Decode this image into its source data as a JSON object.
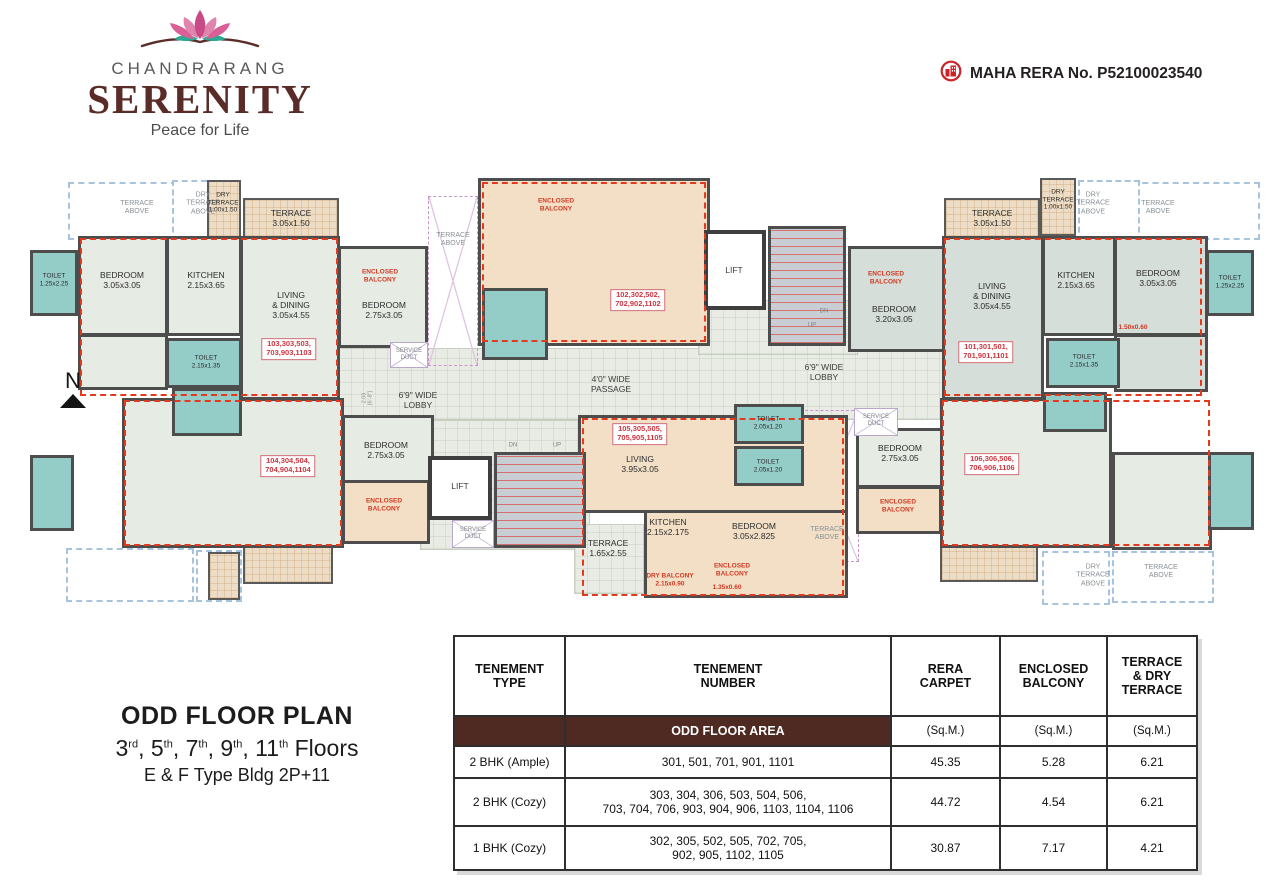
{
  "header": {
    "brand": "CHANDRARANG",
    "title": "SERENITY",
    "tagline": "Peace for Life",
    "rera_label": "MAHA RERA No. P52100023540"
  },
  "plan_info": {
    "title": "ODD FLOOR PLAN",
    "floors": [
      [
        "3",
        "rd"
      ],
      [
        "5",
        "th"
      ],
      [
        "7",
        "th"
      ],
      [
        "9",
        "th"
      ],
      [
        "11",
        "th"
      ]
    ],
    "floors_suffix": "Floors",
    "building": "E & F Type Bldg 2P+11",
    "north": "N"
  },
  "colors": {
    "brand_maroon": "#5a2c28",
    "band_brown": "#4e2a22",
    "unit_red": "#e4391c",
    "toilet_teal": "#94ccc8",
    "unit_tan": "#f2dfc6",
    "room_green": "#e6ebe3",
    "rera_red": "#cc2229"
  },
  "floorplan": {
    "shapes": [
      {
        "n": "lobby-main",
        "c": "lobby",
        "x": 338,
        "y": 348,
        "w": 622,
        "h": 72
      },
      {
        "n": "lobby-core-top",
        "c": "lobby",
        "x": 698,
        "y": 300,
        "w": 160,
        "h": 55
      },
      {
        "n": "lobby-core-bottom",
        "c": "lobby",
        "x": 420,
        "y": 420,
        "w": 170,
        "h": 130
      },
      {
        "n": "terrace-above-left-1",
        "c": "dashb",
        "x": 68,
        "y": 182,
        "w": 140,
        "h": 58
      },
      {
        "n": "dry-terrace-above-left",
        "c": "dashb",
        "x": 172,
        "y": 180,
        "w": 64,
        "h": 62
      },
      {
        "n": "terrace-above-right-1",
        "c": "dashb",
        "x": 1122,
        "y": 182,
        "w": 138,
        "h": 58
      },
      {
        "n": "dry-terrace-above-right",
        "c": "dashb",
        "x": 1078,
        "y": 180,
        "w": 62,
        "h": 62
      },
      {
        "n": "terrace-below-left-1",
        "c": "dashb",
        "x": 66,
        "y": 548,
        "w": 128,
        "h": 54
      },
      {
        "n": "terrace-below-left-2",
        "c": "dashb",
        "x": 196,
        "y": 550,
        "w": 46,
        "h": 52
      },
      {
        "n": "terrace-above-bottom-right",
        "c": "dashb",
        "x": 1112,
        "y": 551,
        "w": 102,
        "h": 52
      },
      {
        "n": "dry-terrace-above-bottom-right",
        "c": "dashb",
        "x": 1042,
        "y": 551,
        "w": 68,
        "h": 54
      },
      {
        "n": "terrace-above-center-left",
        "c": "dashp",
        "x": 428,
        "y": 196,
        "w": 50,
        "h": 170
      },
      {
        "n": "terrace-above-center-bottom",
        "c": "dashp",
        "x": 795,
        "y": 410,
        "w": 64,
        "h": 152
      },
      {
        "n": "dry-terrace-left",
        "c": "terr",
        "x": 207,
        "y": 180,
        "w": 34,
        "h": 58
      },
      {
        "n": "terrace-103",
        "c": "terr",
        "x": 243,
        "y": 198,
        "w": 96,
        "h": 40
      },
      {
        "n": "terrace-101",
        "c": "terr",
        "x": 944,
        "y": 198,
        "w": 96,
        "h": 40
      },
      {
        "n": "dry-terrace-right",
        "c": "terr",
        "x": 1040,
        "y": 178,
        "w": 36,
        "h": 58
      },
      {
        "n": "terrace-104",
        "c": "terr",
        "x": 243,
        "y": 536,
        "w": 90,
        "h": 48
      },
      {
        "n": "terrace-104-strip",
        "c": "terr",
        "x": 208,
        "y": 552,
        "w": 32,
        "h": 48
      },
      {
        "n": "terrace-106",
        "c": "terr",
        "x": 940,
        "y": 534,
        "w": 98,
        "h": 48
      },
      {
        "n": "bedroom-103",
        "c": "room",
        "x": 78,
        "y": 236,
        "w": 90,
        "h": 100
      },
      {
        "n": "kitchen-103",
        "c": "room",
        "x": 166,
        "y": 236,
        "w": 76,
        "h": 100
      },
      {
        "n": "living-dining-103",
        "c": "room",
        "x": 240,
        "y": 236,
        "w": 100,
        "h": 164
      },
      {
        "n": "passage-103",
        "c": "room",
        "x": 78,
        "y": 334,
        "w": 90,
        "h": 56
      },
      {
        "n": "bedroom2-103",
        "c": "room",
        "x": 338,
        "y": 246,
        "w": 90,
        "h": 102
      },
      {
        "n": "bedroom2-101",
        "c": "groom",
        "x": 848,
        "y": 246,
        "w": 102,
        "h": 106
      },
      {
        "n": "living-dining-101",
        "c": "groom",
        "x": 942,
        "y": 236,
        "w": 102,
        "h": 164
      },
      {
        "n": "kitchen-101",
        "c": "groom",
        "x": 1042,
        "y": 236,
        "w": 74,
        "h": 100
      },
      {
        "n": "bedroom-101",
        "c": "groom",
        "x": 1114,
        "y": 236,
        "w": 94,
        "h": 100
      },
      {
        "n": "passage-101",
        "c": "groom",
        "x": 1114,
        "y": 334,
        "w": 94,
        "h": 58
      },
      {
        "n": "unit-104-main",
        "c": "room",
        "x": 122,
        "y": 398,
        "w": 222,
        "h": 150
      },
      {
        "n": "bedroom2-104",
        "c": "room",
        "x": 342,
        "y": 415,
        "w": 92,
        "h": 68
      },
      {
        "n": "bedroom2-106",
        "c": "room",
        "x": 856,
        "y": 428,
        "w": 88,
        "h": 60
      },
      {
        "n": "unit-106-main",
        "c": "room",
        "x": 940,
        "y": 398,
        "w": 172,
        "h": 150
      },
      {
        "n": "bedroom-106",
        "c": "room",
        "x": 1112,
        "y": 452,
        "w": 100,
        "h": 98
      },
      {
        "n": "terrace-105",
        "c": "lobby",
        "x": 574,
        "y": 524,
        "w": 70,
        "h": 70
      },
      {
        "n": "unit-102",
        "c": "tan",
        "x": 478,
        "y": 178,
        "w": 232,
        "h": 168
      },
      {
        "n": "unit-105-upper",
        "c": "tan",
        "x": 578,
        "y": 415,
        "w": 270,
        "h": 98
      },
      {
        "n": "unit-105-lower",
        "c": "tan",
        "x": 644,
        "y": 510,
        "w": 204,
        "h": 88
      },
      {
        "n": "enclosed-balcony-104",
        "c": "tan",
        "x": 342,
        "y": 480,
        "w": 88,
        "h": 64
      },
      {
        "n": "enclosed-balcony-106",
        "c": "tan",
        "x": 856,
        "y": 486,
        "w": 86,
        "h": 48
      },
      {
        "n": "toilet-103-a",
        "c": "toilet",
        "x": 30,
        "y": 250,
        "w": 48,
        "h": 66
      },
      {
        "n": "toilet-103-b",
        "c": "toilet",
        "x": 166,
        "y": 338,
        "w": 76,
        "h": 50
      },
      {
        "n": "toilet-102",
        "c": "toilet",
        "x": 482,
        "y": 288,
        "w": 66,
        "h": 72
      },
      {
        "n": "toilet-101-a",
        "c": "toilet",
        "x": 1206,
        "y": 250,
        "w": 48,
        "h": 66
      },
      {
        "n": "toilet-101-b",
        "c": "toilet",
        "x": 1046,
        "y": 338,
        "w": 74,
        "h": 50
      },
      {
        "n": "toilet-104-a",
        "c": "toilet",
        "x": 172,
        "y": 388,
        "w": 70,
        "h": 48
      },
      {
        "n": "toilet-104-b",
        "c": "toilet",
        "x": 30,
        "y": 455,
        "w": 44,
        "h": 76
      },
      {
        "n": "toilet-105-a",
        "c": "toilet",
        "x": 734,
        "y": 404,
        "w": 70,
        "h": 40
      },
      {
        "n": "toilet-105-b",
        "c": "toilet",
        "x": 734,
        "y": 446,
        "w": 70,
        "h": 40
      },
      {
        "n": "toilet-106-a",
        "c": "toilet",
        "x": 1043,
        "y": 392,
        "w": 64,
        "h": 40
      },
      {
        "n": "toilet-106-b",
        "c": "toilet",
        "x": 1208,
        "y": 452,
        "w": 46,
        "h": 78
      },
      {
        "n": "lift-1",
        "c": "lift",
        "x": 704,
        "y": 230,
        "w": 62,
        "h": 80
      },
      {
        "n": "staircase-1",
        "c": "stair",
        "x": 768,
        "y": 226,
        "w": 78,
        "h": 120
      },
      {
        "n": "lift-2",
        "c": "lift",
        "x": 428,
        "y": 456,
        "w": 64,
        "h": 64
      },
      {
        "n": "staircase-2",
        "c": "stair",
        "x": 494,
        "y": 452,
        "w": 92,
        "h": 96
      },
      {
        "n": "service-duct-1",
        "c": "duct",
        "x": 390,
        "y": 342,
        "w": 38,
        "h": 26
      },
      {
        "n": "service-duct-2",
        "c": "duct",
        "x": 452,
        "y": 520,
        "w": 42,
        "h": 28
      },
      {
        "n": "service-duct-3",
        "c": "duct",
        "x": 854,
        "y": 408,
        "w": 44,
        "h": 28
      },
      {
        "n": "unit-boundary-103",
        "c": "dashr",
        "x": 80,
        "y": 238,
        "w": 258,
        "h": 158
      },
      {
        "n": "unit-boundary-102",
        "c": "dashr",
        "x": 482,
        "y": 182,
        "w": 224,
        "h": 160
      },
      {
        "n": "unit-boundary-101",
        "c": "dashr",
        "x": 944,
        "y": 238,
        "w": 258,
        "h": 158
      },
      {
        "n": "unit-boundary-104",
        "c": "dashr",
        "x": 124,
        "y": 400,
        "w": 218,
        "h": 146
      },
      {
        "n": "unit-boundary-105",
        "c": "dashr",
        "x": 582,
        "y": 418,
        "w": 262,
        "h": 178
      },
      {
        "n": "unit-boundary-106",
        "c": "dashr",
        "x": 942,
        "y": 400,
        "w": 268,
        "h": 146
      }
    ],
    "labels": [
      {
        "n": "label-terrace-above-l",
        "t": "TERRACE\nABOVE",
        "x": 137,
        "y": 208,
        "c": "a"
      },
      {
        "n": "label-dry-terrace-above-l",
        "t": "DRY\nTERRACE\nABOVE",
        "x": 203,
        "y": 204,
        "c": "a"
      },
      {
        "n": "label-dry-terrace-l",
        "t": "DRY\nTERRACE\n1.00x1.50",
        "x": 223,
        "y": 203,
        "c": "s"
      },
      {
        "n": "label-terrace-103",
        "t": "TERRACE\n3.05x1.50",
        "x": 291,
        "y": 218,
        "c": "r"
      },
      {
        "n": "label-toilet-103a",
        "t": "TOILET\n1.25x2.25",
        "x": 54,
        "y": 280,
        "c": "s"
      },
      {
        "n": "label-bedroom-103",
        "t": "BEDROOM\n3.05x3.05",
        "x": 122,
        "y": 280,
        "c": "r"
      },
      {
        "n": "label-kitchen-103",
        "t": "KITCHEN\n2.15x3.65",
        "x": 206,
        "y": 280,
        "c": "r"
      },
      {
        "n": "label-living-103",
        "t": "LIVING\n& DINING\n3.05x4.55",
        "x": 291,
        "y": 305,
        "c": "r"
      },
      {
        "n": "unit-103-label",
        "t": "103,303,503,\n703,903,1103",
        "x": 289,
        "y": 349,
        "c": "u"
      },
      {
        "n": "label-toilet-103b",
        "t": "TOILET\n2.15x1.35",
        "x": 206,
        "y": 362,
        "c": "s"
      },
      {
        "n": "label-encbal-103",
        "t": "ENCLOSED\nBALCONY",
        "x": 380,
        "y": 276,
        "c": "red"
      },
      {
        "n": "label-bedroom2-103",
        "t": "BEDROOM\n2.75x3.05",
        "x": 384,
        "y": 310,
        "c": "r"
      },
      {
        "n": "label-terrace-above-cl",
        "t": "TERRACE\nABOVE",
        "x": 453,
        "y": 240,
        "c": "a"
      },
      {
        "n": "label-duct-1",
        "t": "SERVICE\nDUCT",
        "x": 409,
        "y": 355,
        "c": "dim"
      },
      {
        "n": "label-encbal-102",
        "t": "ENCLOSED\nBALCONY",
        "x": 556,
        "y": 205,
        "c": "red"
      },
      {
        "n": "unit-102-label",
        "t": "102,302,502,\n702,902,1102",
        "x": 638,
        "y": 300,
        "c": "u"
      },
      {
        "n": "label-lift-1",
        "t": "LIFT",
        "x": 734,
        "y": 270,
        "c": "lob"
      },
      {
        "n": "label-dn-1",
        "t": "DN",
        "x": 824,
        "y": 312,
        "c": "dim"
      },
      {
        "n": "label-up-1",
        "t": "UP",
        "x": 812,
        "y": 326,
        "c": "dim"
      },
      {
        "n": "label-lobby-left",
        "t": "6'9\" WIDE\nLOBBY",
        "x": 418,
        "y": 400,
        "c": "lob"
      },
      {
        "n": "label-lobby-dim",
        "t": "2.03\n[6'-8\"]",
        "x": 368,
        "y": 398,
        "c": "dimv"
      },
      {
        "n": "label-passage",
        "t": "4'0\" WIDE\nPASSAGE",
        "x": 611,
        "y": 384,
        "c": "lob"
      },
      {
        "n": "label-lobby-right",
        "t": "6'9\" WIDE\nLOBBY",
        "x": 824,
        "y": 372,
        "c": "lob"
      },
      {
        "n": "label-encbal-101",
        "t": "ENCLOSED\nBALCONY",
        "x": 886,
        "y": 278,
        "c": "red"
      },
      {
        "n": "label-bedroom2-101",
        "t": "BEDROOM\n3.20x3.05",
        "x": 894,
        "y": 314,
        "c": "r"
      },
      {
        "n": "label-terrace-101",
        "t": "TERRACE\n3.05x1.50",
        "x": 992,
        "y": 218,
        "c": "r"
      },
      {
        "n": "label-living-101",
        "t": "LIVING\n& DINING\n3.05x4.55",
        "x": 992,
        "y": 296,
        "c": "r"
      },
      {
        "n": "unit-101-label",
        "t": "101,301,501,\n701,901,1101",
        "x": 986,
        "y": 352,
        "c": "u"
      },
      {
        "n": "label-dry-terrace-r",
        "t": "DRY\nTERRACE\n1.00x1.50",
        "x": 1058,
        "y": 200,
        "c": "s"
      },
      {
        "n": "label-dry-terrace-above-r",
        "t": "DRY\nTERRACE\nABOVE",
        "x": 1093,
        "y": 204,
        "c": "a"
      },
      {
        "n": "label-terrace-above-r",
        "t": "TERRACE\nABOVE",
        "x": 1158,
        "y": 208,
        "c": "a"
      },
      {
        "n": "label-kitchen-101",
        "t": "KITCHEN\n2.15x3.65",
        "x": 1076,
        "y": 280,
        "c": "r"
      },
      {
        "n": "label-bedroom-101",
        "t": "BEDROOM\n3.05x3.05",
        "x": 1158,
        "y": 278,
        "c": "r"
      },
      {
        "n": "label-toilet-101a",
        "t": "TOILET\n1.25x2.25",
        "x": 1230,
        "y": 282,
        "c": "s"
      },
      {
        "n": "label-dim-150x060",
        "t": "1.50x0.60",
        "x": 1133,
        "y": 328,
        "c": "red"
      },
      {
        "n": "label-toilet-101b",
        "t": "TOILET\n2.15x1.35",
        "x": 1084,
        "y": 361,
        "c": "s"
      },
      {
        "n": "label-duct-3",
        "t": "SERVICE\nDUCT",
        "x": 876,
        "y": 421,
        "c": "dim"
      },
      {
        "n": "unit-104-label",
        "t": "104,304,504,\n704,904,1104",
        "x": 288,
        "y": 466,
        "c": "u"
      },
      {
        "n": "label-bedroom2-104",
        "t": "BEDROOM\n2.75x3.05",
        "x": 386,
        "y": 450,
        "c": "r"
      },
      {
        "n": "label-encbal-104",
        "t": "ENCLOSED\nBALCONY",
        "x": 384,
        "y": 505,
        "c": "red"
      },
      {
        "n": "label-lift-2",
        "t": "LIFT",
        "x": 460,
        "y": 486,
        "c": "lob"
      },
      {
        "n": "label-duct-2",
        "t": "SERVICE\nDUCT",
        "x": 473,
        "y": 534,
        "c": "dim"
      },
      {
        "n": "label-dn-2",
        "t": "DN",
        "x": 513,
        "y": 446,
        "c": "dim"
      },
      {
        "n": "label-up-2",
        "t": "UP",
        "x": 557,
        "y": 446,
        "c": "dim"
      },
      {
        "n": "unit-105-label",
        "t": "105,305,505,\n705,905,1105",
        "x": 640,
        "y": 434,
        "c": "u"
      },
      {
        "n": "label-living-105",
        "t": "LIVING\n3.95x3.05",
        "x": 640,
        "y": 464,
        "c": "r"
      },
      {
        "n": "label-toilet-105a",
        "t": "TOILET\n2.05x1.20",
        "x": 768,
        "y": 423,
        "c": "s"
      },
      {
        "n": "label-toilet-105b",
        "t": "TOILET\n2.05x1.20",
        "x": 768,
        "y": 466,
        "c": "s"
      },
      {
        "n": "label-kitchen-105",
        "t": "KITCHEN\n2.15x2.175",
        "x": 668,
        "y": 527,
        "c": "r"
      },
      {
        "n": "label-bedroom-105",
        "t": "BEDROOM\n3.05x2.825",
        "x": 754,
        "y": 531,
        "c": "r"
      },
      {
        "n": "label-terrace-105",
        "t": "TERRACE\n1.65x2.55",
        "x": 608,
        "y": 548,
        "c": "r"
      },
      {
        "n": "label-drybal-105",
        "t": "DRY BALCONY\n2.15x0.90",
        "x": 670,
        "y": 580,
        "c": "red"
      },
      {
        "n": "label-encbal-105",
        "t": "ENCLOSED\nBALCONY",
        "x": 732,
        "y": 570,
        "c": "red"
      },
      {
        "n": "label-dim-135x060",
        "t": "1.35x0.60",
        "x": 727,
        "y": 588,
        "c": "red"
      },
      {
        "n": "label-terrace-above-cb",
        "t": "TERRACE\nABOVE",
        "x": 827,
        "y": 534,
        "c": "a"
      },
      {
        "n": "label-bedroom2-106",
        "t": "BEDROOM\n2.75x3.05",
        "x": 900,
        "y": 453,
        "c": "r"
      },
      {
        "n": "label-encbal-106",
        "t": "ENCLOSED\nBALCONY",
        "x": 898,
        "y": 506,
        "c": "red"
      },
      {
        "n": "unit-106-label",
        "t": "106,306,506,\n706,906,1106",
        "x": 992,
        "y": 464,
        "c": "u"
      },
      {
        "n": "label-dry-terrace-above-br",
        "t": "DRY\nTERRACE\nABOVE",
        "x": 1093,
        "y": 576,
        "c": "a"
      },
      {
        "n": "label-terrace-above-br",
        "t": "TERRACE\nABOVE",
        "x": 1161,
        "y": 572,
        "c": "a"
      }
    ]
  },
  "table": {
    "col_headers": [
      "TENEMENT\nTYPE",
      "TENEMENT\nNUMBER",
      "RERA\nCARPET",
      "ENCLOSED\nBALCONY",
      "TERRACE\n& DRY\nTERRACE"
    ],
    "band_label": "ODD FLOOR AREA",
    "unit_label": "(Sq.M.)",
    "rows": [
      {
        "type": "2 BHK (Ample)",
        "numbers": "301, 501, 701, 901, 1101",
        "rera": "45.35",
        "balcony": "5.28",
        "terrace": "6.21"
      },
      {
        "type": "2 BHK (Cozy)",
        "numbers": "303, 304, 306, 503, 504, 506,\n703, 704, 706, 903, 904, 906, 1103, 1104, 1106",
        "rera": "44.72",
        "balcony": "4.54",
        "terrace": "6.21"
      },
      {
        "type": "1 BHK (Cozy)",
        "numbers": "302, 305, 502, 505, 702, 705,\n902, 905, 1102, 1105",
        "rera": "30.87",
        "balcony": "7.17",
        "terrace": "4.21"
      }
    ]
  }
}
